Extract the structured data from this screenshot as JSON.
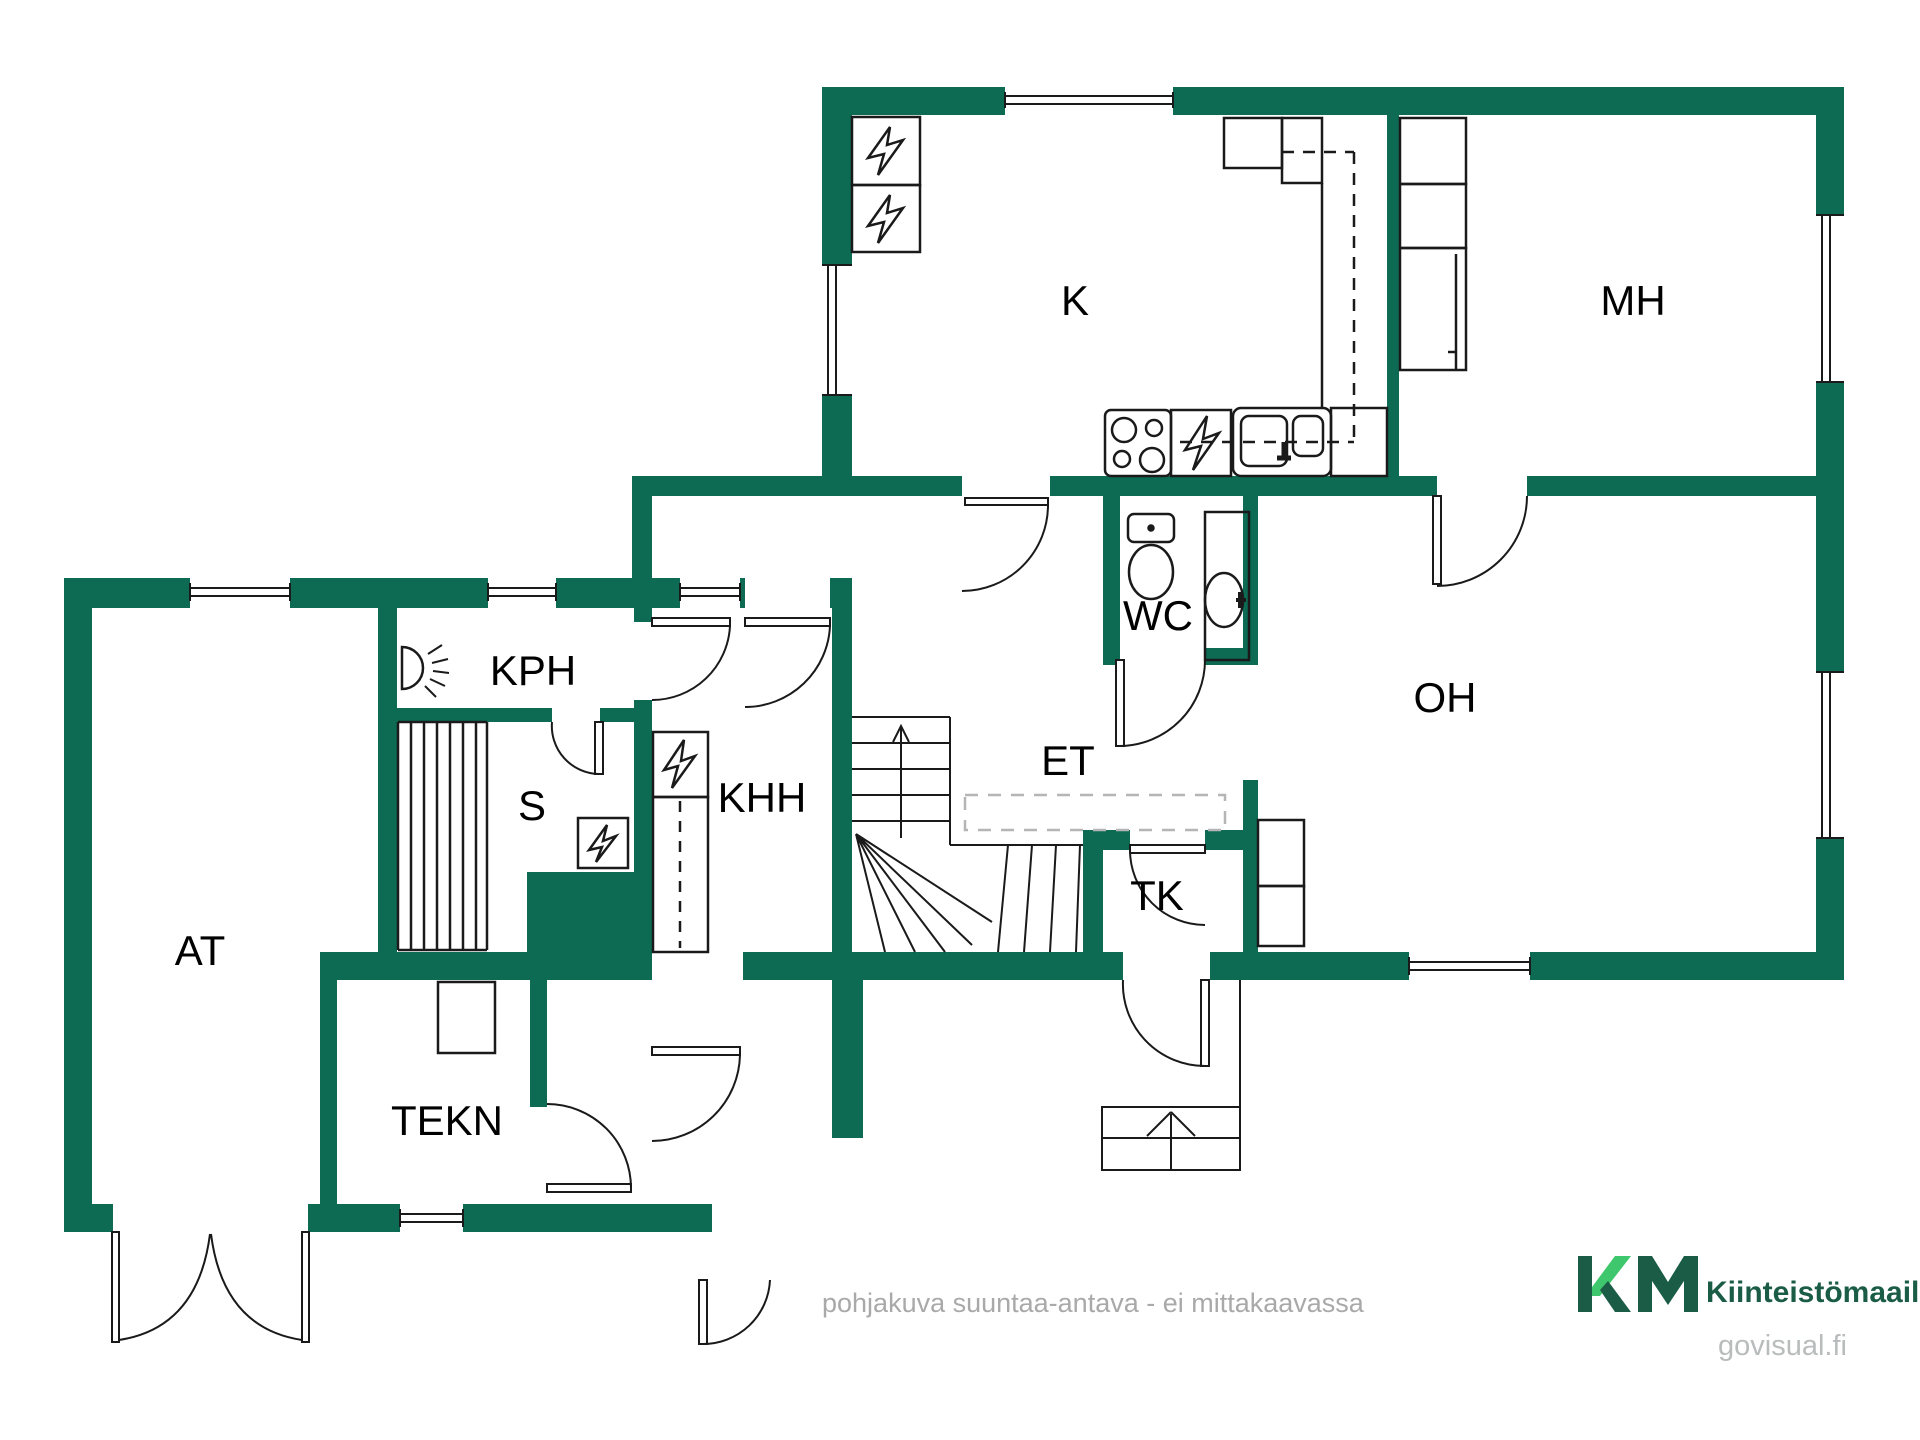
{
  "plan": {
    "type": "floor-plan",
    "rooms": [
      {
        "id": "k",
        "label": "K"
      },
      {
        "id": "mh",
        "label": "MH"
      },
      {
        "id": "oh",
        "label": "OH"
      },
      {
        "id": "wc",
        "label": "WC"
      },
      {
        "id": "et",
        "label": "ET"
      },
      {
        "id": "tk",
        "label": "TK"
      },
      {
        "id": "kph",
        "label": "KPH"
      },
      {
        "id": "s",
        "label": "S"
      },
      {
        "id": "khh",
        "label": "KHH"
      },
      {
        "id": "at",
        "label": "AT"
      },
      {
        "id": "tekn",
        "label": "TEKN"
      }
    ],
    "fixtures": [
      "stove",
      "dishwasher",
      "kitchen-sink",
      "fridge-appliances",
      "toilet",
      "wash-basin",
      "shower",
      "sauna-bench",
      "sauna-heater",
      "laundry-appliance",
      "tall-cabinet",
      "wardrobes",
      "fireplace",
      "stairs-up",
      "entry-steps",
      "garage-double-door"
    ],
    "colors": {
      "wall": "#0d6b54",
      "line": "#1a1a1a",
      "label": "#000000",
      "watermark": "#a9a9a9",
      "brand_dark": "#1a5c45",
      "brand_light": "#3fc76d",
      "site_gray": "#b9bcbc"
    }
  },
  "footer": {
    "watermark": "pohjakuva suuntaa-antava - ei mittakaavassa"
  },
  "branding": {
    "logo": "KM",
    "name": "Kiinteistömaailma",
    "site": "govisual.fi"
  }
}
